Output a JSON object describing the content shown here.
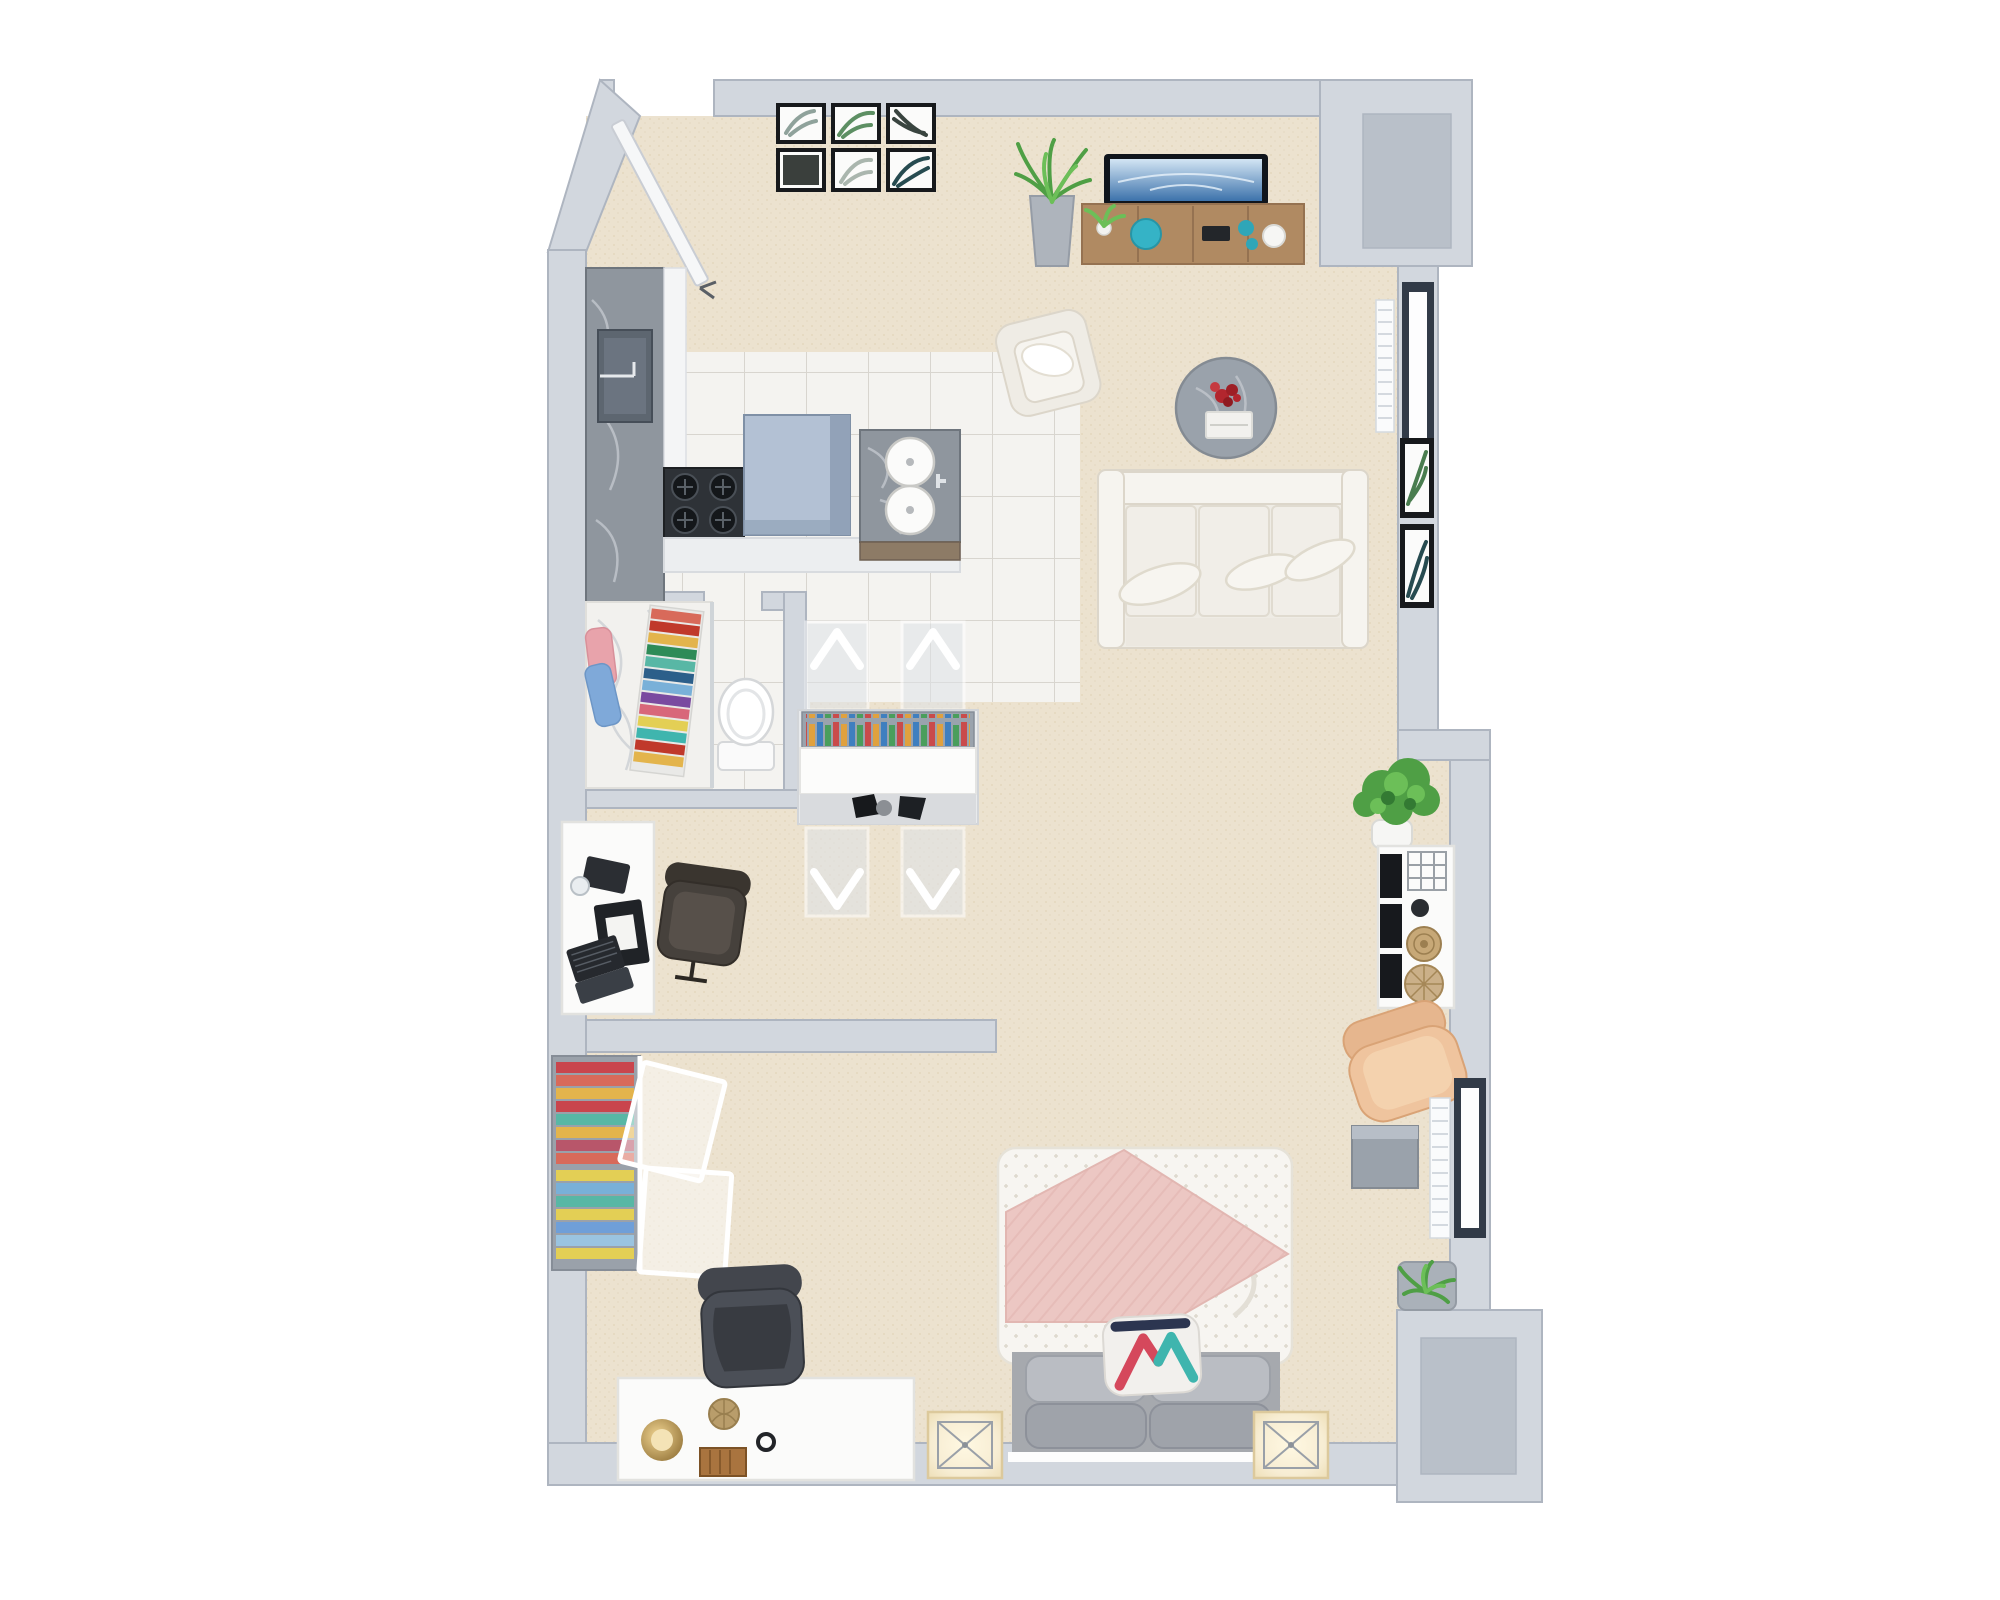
{
  "scene": {
    "description": "3D rendered top-down floor plan of a studio apartment, white background",
    "background": "#ffffff"
  },
  "palette": {
    "bg": "#ffffff",
    "wall": "#d2d7de",
    "wall_edge": "#aeb5c0",
    "wall_top": "#eef0f4",
    "niche_floor": "#b9c0c9",
    "carpet": "#ece2cf",
    "carpet_dot": "#ddcfb3",
    "tile": "#f4f3f0",
    "tile_line": "#d8d5cf",
    "marble_gray": "#8f969e",
    "marble_gray_dark": "#6e757d",
    "marble_vein": "#c2c7cd",
    "marble_white": "#f2f1ee",
    "marble_white_vein": "#cfd3d6",
    "sink_dark": "#5d6670",
    "stove_dark": "#2e3237",
    "island_top": "#b3c1d4",
    "island_side": "#92a2b8",
    "counter_white": "#eceef0",
    "wood": "#b08a62",
    "wood_edge": "#957251",
    "wood_dark": "#8d7b66",
    "teal": "#35b3c6",
    "tv_frame": "#10151c",
    "tv_screen_top": "#d3e5f4",
    "tv_screen_bottom": "#3c72ab",
    "sofa": "#efece5",
    "sofa_edge": "#dcd6ca",
    "sofa_light": "#f6f4ef",
    "table_marble": "#9aa2ab",
    "flower_red": "#b2262e",
    "plant_green": "#4f9f45",
    "plant_green_light": "#6cbf58",
    "plant_green_dark": "#337a33",
    "leather": "#efc49e",
    "leather_edge": "#d9a376",
    "window_frame": "#323b48",
    "glass": "#fdfdfe",
    "radiator": "#fafbfc",
    "radiator_line": "#d4d9df",
    "frame_black": "#17191c",
    "mat_white": "#fbfbfa",
    "duvet": "#f7f5f1",
    "duvet_edge": "#e6e2d8",
    "blanket_pink": "#ecc7c3",
    "blanket_pink_line": "#dfb1ac",
    "bed_gray": "#a6a9ae",
    "pillow_gray": "#babdc3",
    "pillow_gray2": "#9fa3aa",
    "accent_red": "#d5485c",
    "accent_teal": "#3fb5ae",
    "accent_navy": "#2c3550",
    "glow": "#f7edd3",
    "glow_edge": "#dcc99c",
    "desk_white": "#fbfbfa",
    "desk_edge": "#e2e2df",
    "chair_dark": "#4b4f57",
    "chair_dark2": "#383b41",
    "chair_brown": "#46413c",
    "brass": "#c19a4f",
    "wicker": "#b99d6b",
    "wood_box": "#a9743f",
    "book_1": "#c94b4b",
    "book_2": "#e0a13e",
    "book_3": "#3f7fbf",
    "book_4": "#4a9e5c",
    "cloth_1": "#c9454d",
    "cloth_2": "#e3b44c",
    "cloth_3": "#58b7a5",
    "cloth_4": "#79b0d8",
    "cloth_5": "#d86a5a",
    "cloth_6": "#e3cf55"
  },
  "rooms": [
    {
      "key": "entry",
      "name": "Entry hall"
    },
    {
      "key": "kitchen",
      "name": "Kitchen"
    },
    {
      "key": "bathroom",
      "name": "Bathroom"
    },
    {
      "key": "dining",
      "name": "Dining area"
    },
    {
      "key": "office",
      "name": "Office nook"
    },
    {
      "key": "closet",
      "name": "Closet"
    },
    {
      "key": "living",
      "name": "Living area"
    },
    {
      "key": "bedroom",
      "name": "Bedroom"
    }
  ],
  "entry": {
    "door": {
      "name": "Entry door, open"
    },
    "gallery": {
      "name": "Gallery wall: six framed botanical palm prints (2 rows x 3 columns)",
      "frames": [
        {
          "leaf": "#8fa29b"
        },
        {
          "leaf": "#5d8f63"
        },
        {
          "leaf": "#39443f"
        },
        {
          "leaf": "#3a3f3c"
        },
        {
          "leaf": "#aab6ae"
        },
        {
          "leaf": "#274b50"
        }
      ]
    }
  },
  "furniture": {
    "kitchen_counter": {
      "name": "Gray marble kitchen counter with sink"
    },
    "kitchen_sink": {
      "name": "Undermount kitchen sink with faucet"
    },
    "stove": {
      "name": "Four-burner gas cooktop"
    },
    "island": {
      "name": "Kitchen island with blue-gray top"
    },
    "peninsula": {
      "name": "White counter peninsula"
    },
    "vanity": {
      "name": "Gray marble vanity with two round basins"
    },
    "shower": {
      "name": "White marble shower area"
    },
    "towels_hanging": {
      "name": "Pink and blue hanging towels"
    },
    "towels_rainbow": {
      "name": "Rack of colorful folded towels"
    },
    "toilet": {
      "name": "Toilet"
    },
    "dining_table": {
      "name": "White dining table with bookshelf of colorful books"
    },
    "dining_chair": {
      "name": "Acrylic chevron dining chair"
    },
    "office_desk": {
      "name": "White office desk with laptop and notebooks"
    },
    "office_chair": {
      "name": "Dark office swivel chair"
    },
    "closet_rack": {
      "name": "Open closet rack with colorful folded clothes"
    },
    "closet_door": {
      "name": "White-framed closet door, open"
    },
    "tv": {
      "name": "Flat-screen TV"
    },
    "tv_console": {
      "name": "Wooden media console with teal decor"
    },
    "plant_tall": {
      "name": "Tall potted snake plant"
    },
    "plant_small": {
      "name": "Small potted plant"
    },
    "armchair": {
      "name": "White armchair"
    },
    "coffee_table": {
      "name": "Round gray marble coffee table with red flowers and book"
    },
    "sofa": {
      "name": "White three-seat sofa with throw pillows"
    },
    "wall_art_right": {
      "name": "Two framed palm prints on right wall"
    },
    "window_upper": {
      "name": "Window, dark frame (upper right wall)"
    },
    "window_lower": {
      "name": "Window, dark frame (lower right wall)"
    },
    "radiator_upper": {
      "name": "Radiator under upper window"
    },
    "radiator_lower": {
      "name": "Radiator under lower window"
    },
    "plant_large": {
      "name": "Large potted plant in white pot"
    },
    "sideboard": {
      "name": "White sideboard with black shelf fronts, wire basket and rattan baskets"
    },
    "lounge_chair": {
      "name": "Tan leather lounge chair"
    },
    "cube_table": {
      "name": "Gray cube side table"
    },
    "plant_shelf": {
      "name": "Wall shelf with green plant"
    },
    "bed": {
      "name": "Double bed with white duvet"
    },
    "blanket": {
      "name": "Pink chunky-knit blanket"
    },
    "pillows": {
      "name": "Four gray pillows"
    },
    "accent_pillow": {
      "name": "Geometric accent pillow, red teal and navy"
    },
    "nightstand_left": {
      "name": "Left nightstand with glowing lamp"
    },
    "nightstand_right": {
      "name": "Right nightstand with glowing lamp"
    },
    "bedroom_desk": {
      "name": "White bedroom desk with brass bowl, wicker ball and wooden box"
    },
    "desk_chair": {
      "name": "Dark gray desk chair"
    },
    "niche_top": {
      "name": "Top-right wall niche"
    },
    "niche_bottom": {
      "name": "Bottom-right wall niche"
    }
  }
}
